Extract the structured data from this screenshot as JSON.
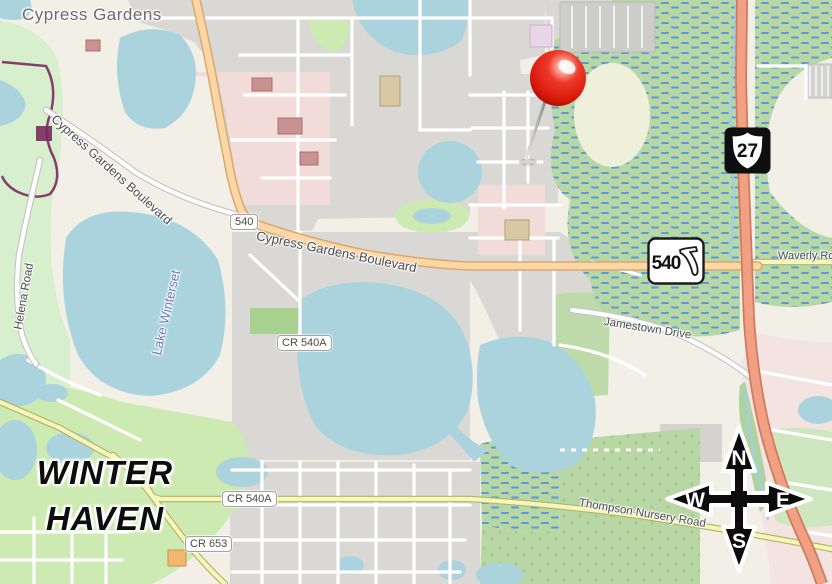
{
  "map": {
    "places": {
      "suburb": "Cypress Gardens",
      "city_line1": "WINTER",
      "city_line2": "HAVEN",
      "lake": "Lake Winterset"
    },
    "roads": {
      "boulevard": "Cypress Gardens Boulevard",
      "helena": "Helena Road",
      "waverly": "Waverly Road",
      "jamestown": "Jamestown Drive",
      "thompson": "Thompson Nursery Road"
    },
    "route_markers": {
      "us_highway": "27",
      "state_road": "540",
      "ref_primary": "540",
      "county_road_540a": "CR 540A",
      "county_road_653": "CR 653"
    },
    "compass": {
      "n": "N",
      "s": "S",
      "e": "E",
      "w": "W"
    },
    "marker": {
      "type": "red pushpin"
    },
    "colors": {
      "water": "#abd3de",
      "wetland_green": "#b7d8a6",
      "park_green": "#cdeab3",
      "urban_gray": "#d9d8d4",
      "trunk_road": "#f1a084",
      "primary_road": "#fcd6a4",
      "pin_red": "#e02417"
    }
  }
}
